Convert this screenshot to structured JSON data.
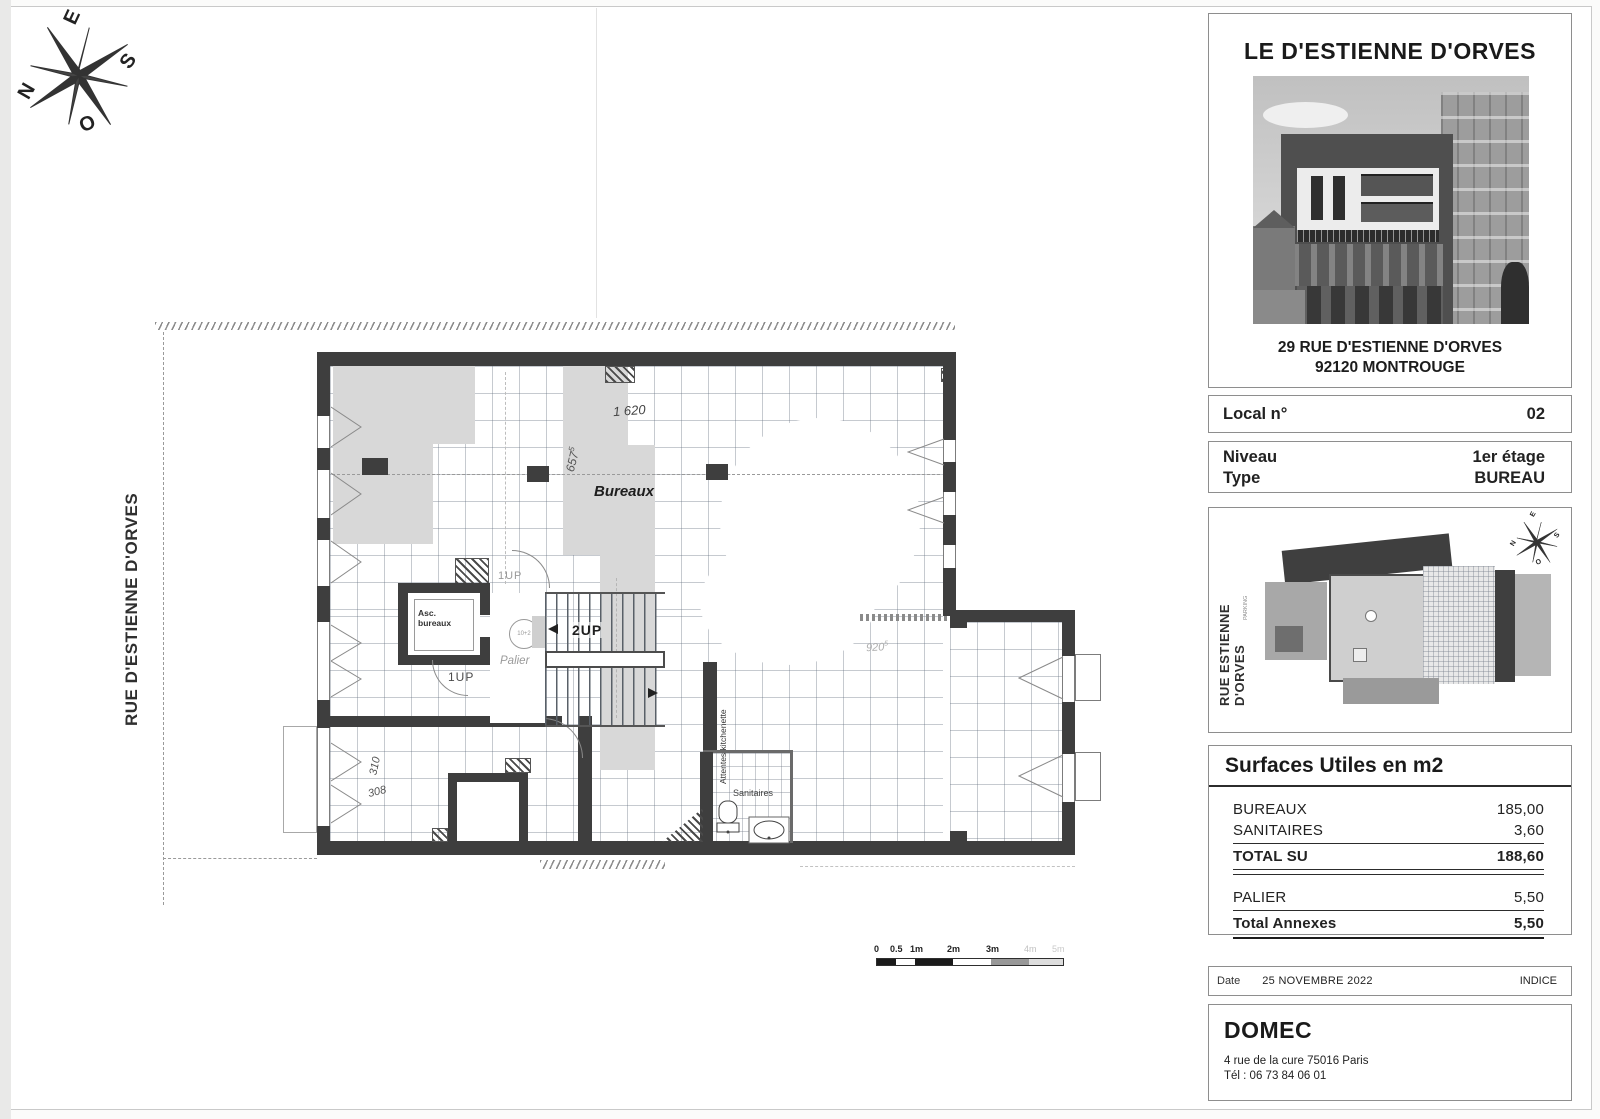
{
  "compass": {
    "e": "E",
    "s": "S",
    "o": "O",
    "n": "N"
  },
  "plan": {
    "street": "RUE D'ESTIENNE D'ORVES",
    "room": "Bureaux",
    "labels": {
      "asc1": "Asc.",
      "asc2": "bureaux",
      "palier": "Palier",
      "sanitaires": "Sanitaires",
      "kitchenette": "Attentes kitchenette",
      "up_top": "1UP",
      "up_mid": "2UP",
      "up_bottom": "1UP",
      "lift_note": "10+2"
    },
    "dims": {
      "d1": "1 620",
      "d2": "657",
      "d2sup": "5",
      "d3": "920",
      "d3sup": "5",
      "r1": "310",
      "r2": "308"
    },
    "scalebar": {
      "ticks": [
        "0",
        "0.5",
        "1m",
        "2m",
        "3m"
      ],
      "faint": [
        "4m",
        "5m"
      ]
    }
  },
  "panel": {
    "title": "LE D'ESTIENNE D'ORVES",
    "address1": "29 RUE D'ESTIENNE D'ORVES",
    "address2": "92120 MONTROUGE",
    "local": {
      "label": "Local n°",
      "value": "02"
    },
    "niveau": {
      "label": "Niveau",
      "value": "1er étage"
    },
    "type": {
      "label": "Type",
      "value": "BUREAU"
    },
    "siteplan": {
      "street": "RUE ESTIENNE D'ORVES",
      "parking": "PARKING"
    },
    "surfaces": {
      "title": "Surfaces Utiles en m2",
      "rows": [
        {
          "label": "BUREAUX",
          "value": "185,00"
        },
        {
          "label": "SANITAIRES",
          "value": "3,60"
        },
        {
          "label": "TOTAL SU",
          "value": "188,60"
        },
        {
          "label": "PALIER",
          "value": "5,50"
        },
        {
          "label": "Total Annexes",
          "value": "5,50"
        }
      ]
    },
    "date": {
      "label": "Date",
      "value": "25 NOVEMBRE 2022",
      "indice": "INDICE"
    },
    "firm": {
      "name": "DOMEC",
      "address": "4  rue de la cure 75016 Paris",
      "tel": "Tél : 06 73 84 06 01"
    }
  }
}
